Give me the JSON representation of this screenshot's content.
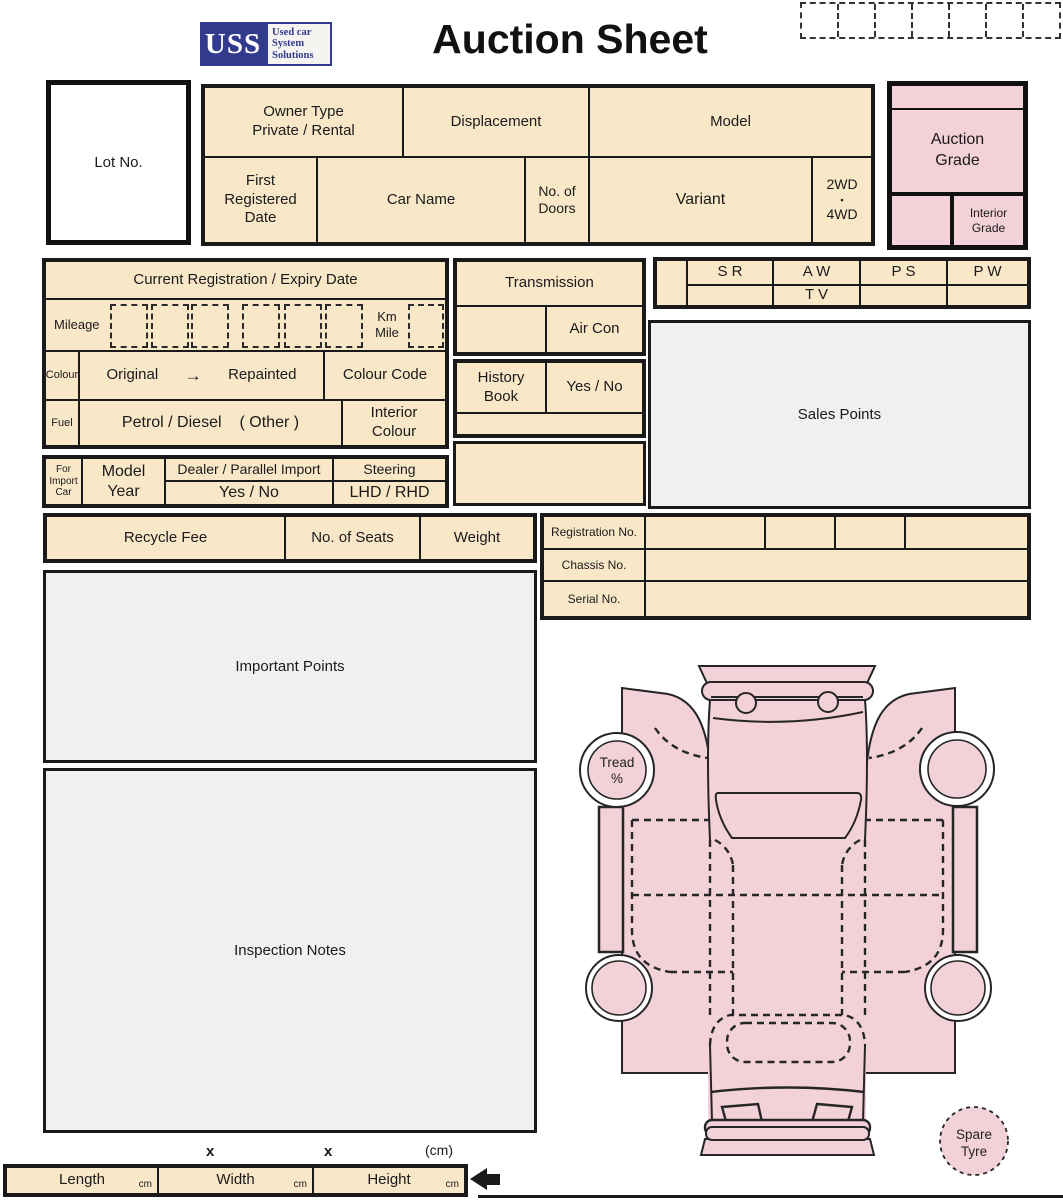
{
  "colors": {
    "beige": "#f8e8c8",
    "pink": "#f2d1d8",
    "navy": "#323a8e",
    "box_gray": "#f0f0f0",
    "line": "#1a1a1a"
  },
  "header": {
    "logo": {
      "acronym": "USS",
      "line1": "Used car",
      "line2": "System",
      "line3": "Solutions"
    },
    "title": "Auction Sheet"
  },
  "lot": {
    "label": "Lot No."
  },
  "top": {
    "owner1": "Owner Type",
    "owner2": "Private / Rental",
    "displacement": "Displacement",
    "model": "Model",
    "reg1": "First",
    "reg2": "Registered",
    "reg3": "Date",
    "car_name": "Car Name",
    "doors1": "No. of",
    "doors2": "Doors",
    "variant": "Variant",
    "wd2": "2WD",
    "wd_sep": "▪",
    "wd4": "4WD"
  },
  "grade": {
    "auction1": "Auction",
    "auction2": "Grade",
    "interior1": "Interior",
    "interior2": "Grade"
  },
  "registration": {
    "title": "Current Registration / Expiry Date",
    "mileage": "Mileage",
    "km": "Km",
    "mile": "Mile",
    "colour": "Colour",
    "original": "Original",
    "arrow": "→",
    "repainted": "Repainted",
    "colour_code": "Colour Code",
    "fuel": "Fuel",
    "fuel_values": "Petrol / Diesel",
    "fuel_other": "( Other )",
    "interior1": "Interior",
    "interior2": "Colour"
  },
  "import": {
    "for1": "For",
    "for2": "Import",
    "for3": "Car",
    "year1": "Model",
    "year2": "Year",
    "dealer": "Dealer / Parallel Import",
    "yes_no": "Yes / No",
    "steering": "Steering",
    "lhd": "LHD / RHD"
  },
  "equipment": {
    "transmission": "Transmission",
    "air_con": "Air Con",
    "history1": "History",
    "history2": "Book",
    "yes_no": "Yes / No",
    "sr": "S R",
    "aw": "A W",
    "ps": "P S",
    "pw": "P W",
    "tv": "T V"
  },
  "sales": {
    "label": "Sales Points"
  },
  "specs": {
    "recycle": "Recycle Fee",
    "seats": "No. of Seats",
    "weight": "Weight"
  },
  "ids": {
    "registration": "Registration No.",
    "chassis": "Chassis No.",
    "serial": "Serial No."
  },
  "notes": {
    "important": "Important Points",
    "inspection": "Inspection Notes"
  },
  "diagram": {
    "tread1": "Tread",
    "tread2": "%",
    "spare1": "Spare",
    "spare2": "Tyre"
  },
  "dims": {
    "length": "Length",
    "width": "Width",
    "height": "Height",
    "unit": "cm",
    "times1": "x",
    "times2": "x",
    "unit_note": "(cm)"
  }
}
